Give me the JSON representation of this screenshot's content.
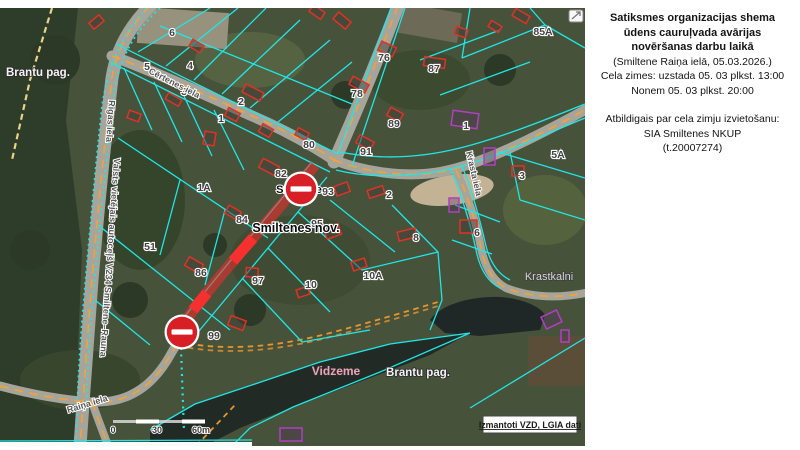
{
  "panel": {
    "title_lines": [
      "Satiksmes organizacijas shema",
      "ūdens cauruļvada avārijas",
      "novēršanas darbu laikā"
    ],
    "info_lines": [
      "(Smiltene Raiņa ielā, 05.03.2026.)",
      "Cela zimes: uzstada 05. 03 plkst. 13:00",
      "Nonem 05. 03 plkst. 20:00"
    ],
    "responsible_lines": [
      "Atbildigais par cela zimju izvietošanu:",
      "SIA Smiltenes NKUP",
      "(t.20007274)"
    ]
  },
  "map": {
    "attribution": "Izmantoti VZD, LGIA dati",
    "scale": {
      "start": "0",
      "mid": "30",
      "end": "60m"
    },
    "parcel_labels": [
      {
        "t": "6",
        "x": 172,
        "y": 36
      },
      {
        "t": "5",
        "x": 147,
        "y": 70
      },
      {
        "t": "4",
        "x": 190,
        "y": 69
      },
      {
        "t": "3",
        "x": 184,
        "y": 95
      },
      {
        "t": "2",
        "x": 241,
        "y": 105
      },
      {
        "t": "1",
        "x": 221,
        "y": 122
      },
      {
        "t": "76",
        "x": 384,
        "y": 61
      },
      {
        "t": "87",
        "x": 434,
        "y": 72
      },
      {
        "t": "85A",
        "x": 543,
        "y": 35
      },
      {
        "t": "78",
        "x": 357,
        "y": 97
      },
      {
        "t": "89",
        "x": 394,
        "y": 127
      },
      {
        "t": "80",
        "x": 309,
        "y": 148
      },
      {
        "t": "91",
        "x": 366,
        "y": 155
      },
      {
        "t": "1",
        "x": 466,
        "y": 129
      },
      {
        "t": "82",
        "x": 281,
        "y": 177
      },
      {
        "t": "93",
        "x": 328,
        "y": 195
      },
      {
        "t": "2",
        "x": 389,
        "y": 198
      },
      {
        "t": "1A",
        "x": 204,
        "y": 191
      },
      {
        "t": "5A",
        "x": 558,
        "y": 158
      },
      {
        "t": "3",
        "x": 522,
        "y": 179
      },
      {
        "t": "84",
        "x": 242,
        "y": 223
      },
      {
        "t": "95",
        "x": 317,
        "y": 227
      },
      {
        "t": "51",
        "x": 150,
        "y": 250
      },
      {
        "t": "6",
        "x": 477,
        "y": 236
      },
      {
        "t": "8",
        "x": 416,
        "y": 241
      },
      {
        "t": "86",
        "x": 201,
        "y": 276
      },
      {
        "t": "97",
        "x": 258,
        "y": 284
      },
      {
        "t": "10A",
        "x": 373,
        "y": 279
      },
      {
        "t": "10",
        "x": 311,
        "y": 288
      },
      {
        "t": "99",
        "x": 214,
        "y": 339
      }
    ],
    "street_labels": [
      {
        "t": "Cērtenes iela",
        "x": 148,
        "y": 73,
        "r": 27
      },
      {
        "t": "Rīgas iela",
        "x": 109,
        "y": 100,
        "r": 94
      },
      {
        "t": "Valsts vietējais autoceļš V234 Smiltene–Rauna",
        "x": 114,
        "y": 158,
        "r": 94
      },
      {
        "t": "Krasta iela",
        "x": 466,
        "y": 152,
        "r": 77
      },
      {
        "t": "Raiņa iela",
        "x": 68,
        "y": 413,
        "r": -17
      }
    ],
    "place_labels": [
      {
        "t": "Brantu pag.",
        "x": 6,
        "y": 76,
        "cls": "lbl-white lbl-start"
      },
      {
        "t": "Smiltene",
        "x": 299,
        "y": 193,
        "cls": "lbl-city"
      },
      {
        "t": "Smiltenes nov.",
        "x": 296,
        "y": 232,
        "cls": "lbl-nov"
      },
      {
        "t": "Vidzeme",
        "x": 336,
        "y": 375,
        "cls": "lbl-pink"
      },
      {
        "t": "Brantu pag.",
        "x": 418,
        "y": 376,
        "cls": "lbl-white"
      },
      {
        "t": "Krastkalni",
        "x": 549,
        "y": 280,
        "cls": "lbl-gray"
      }
    ],
    "signs": [
      {
        "x": 301,
        "y": 189
      },
      {
        "x": 182,
        "y": 332
      }
    ],
    "buildings": [
      {
        "x": 190,
        "y": 42,
        "w": 13,
        "h": 8,
        "r": 30,
        "c": "r"
      },
      {
        "x": 243,
        "y": 88,
        "w": 20,
        "h": 9,
        "r": 28,
        "c": "r"
      },
      {
        "x": 226,
        "y": 110,
        "w": 13,
        "h": 9,
        "r": 28,
        "c": "r"
      },
      {
        "x": 166,
        "y": 96,
        "w": 15,
        "h": 7,
        "r": 30,
        "c": "r"
      },
      {
        "x": 128,
        "y": 112,
        "w": 12,
        "h": 8,
        "r": 20,
        "c": "r"
      },
      {
        "x": 204,
        "y": 132,
        "w": 11,
        "h": 13,
        "r": 10,
        "c": "r"
      },
      {
        "x": 260,
        "y": 126,
        "w": 12,
        "h": 9,
        "r": 30,
        "c": "r"
      },
      {
        "x": 334,
        "y": 16,
        "w": 16,
        "h": 9,
        "r": 40,
        "c": "r"
      },
      {
        "x": 455,
        "y": 28,
        "w": 12,
        "h": 8,
        "r": 20,
        "c": "r"
      },
      {
        "x": 379,
        "y": 44,
        "w": 16,
        "h": 10,
        "r": 25,
        "c": "r"
      },
      {
        "x": 424,
        "y": 58,
        "w": 21,
        "h": 9,
        "r": 8,
        "c": "r"
      },
      {
        "x": 513,
        "y": 12,
        "w": 16,
        "h": 8,
        "r": 30,
        "c": "r"
      },
      {
        "x": 489,
        "y": 23,
        "w": 12,
        "h": 7,
        "r": 32,
        "c": "r"
      },
      {
        "x": 350,
        "y": 80,
        "w": 18,
        "h": 9,
        "r": 28,
        "c": "r"
      },
      {
        "x": 388,
        "y": 110,
        "w": 14,
        "h": 9,
        "r": 28,
        "c": "r"
      },
      {
        "x": 296,
        "y": 130,
        "w": 12,
        "h": 8,
        "r": 28,
        "c": "r"
      },
      {
        "x": 357,
        "y": 138,
        "w": 16,
        "h": 9,
        "r": 28,
        "c": "r"
      },
      {
        "x": 452,
        "y": 112,
        "w": 26,
        "h": 15,
        "r": 8,
        "c": "p"
      },
      {
        "x": 484,
        "y": 148,
        "w": 11,
        "h": 17,
        "r": 0,
        "c": "p"
      },
      {
        "x": 260,
        "y": 162,
        "w": 18,
        "h": 10,
        "r": 28,
        "c": "r"
      },
      {
        "x": 337,
        "y": 182,
        "w": 10,
        "h": 14,
        "r": 70,
        "c": "r"
      },
      {
        "x": 368,
        "y": 188,
        "w": 16,
        "h": 8,
        "r": -18,
        "c": "r"
      },
      {
        "x": 398,
        "y": 230,
        "w": 18,
        "h": 9,
        "r": -14,
        "c": "r"
      },
      {
        "x": 512,
        "y": 166,
        "w": 12,
        "h": 10,
        "r": 0,
        "c": "r"
      },
      {
        "x": 460,
        "y": 220,
        "w": 17,
        "h": 13,
        "r": 0,
        "c": "r"
      },
      {
        "x": 449,
        "y": 198,
        "w": 10,
        "h": 14,
        "r": 0,
        "c": "p"
      },
      {
        "x": 226,
        "y": 208,
        "w": 14,
        "h": 9,
        "r": 30,
        "c": "r"
      },
      {
        "x": 327,
        "y": 224,
        "w": 11,
        "h": 15,
        "r": 70,
        "c": "r"
      },
      {
        "x": 186,
        "y": 260,
        "w": 16,
        "h": 10,
        "r": 30,
        "c": "r"
      },
      {
        "x": 246,
        "y": 268,
        "w": 12,
        "h": 9,
        "r": 5,
        "c": "r"
      },
      {
        "x": 229,
        "y": 318,
        "w": 16,
        "h": 10,
        "r": 20,
        "c": "r"
      },
      {
        "x": 352,
        "y": 260,
        "w": 14,
        "h": 9,
        "r": -18,
        "c": "r"
      },
      {
        "x": 297,
        "y": 288,
        "w": 12,
        "h": 8,
        "r": -18,
        "c": "r"
      },
      {
        "x": 280,
        "y": 428,
        "w": 22,
        "h": 13,
        "r": 0,
        "c": "p"
      },
      {
        "x": 543,
        "y": 313,
        "w": 17,
        "h": 13,
        "r": -25,
        "c": "p"
      },
      {
        "x": 561,
        "y": 330,
        "w": 8,
        "h": 12,
        "r": 0,
        "c": "p"
      },
      {
        "x": 90,
        "y": 18,
        "w": 13,
        "h": 8,
        "r": -40,
        "c": "r"
      },
      {
        "x": 310,
        "y": 8,
        "w": 14,
        "h": 8,
        "r": 35,
        "c": "r"
      }
    ]
  },
  "colors": {
    "closure_red": "#d81f26",
    "cadastral_cyan": "#1fe7e7",
    "road_center_orange": "#f0a23c",
    "building_red": "#e03226",
    "building_purple": "#b13fc4"
  }
}
